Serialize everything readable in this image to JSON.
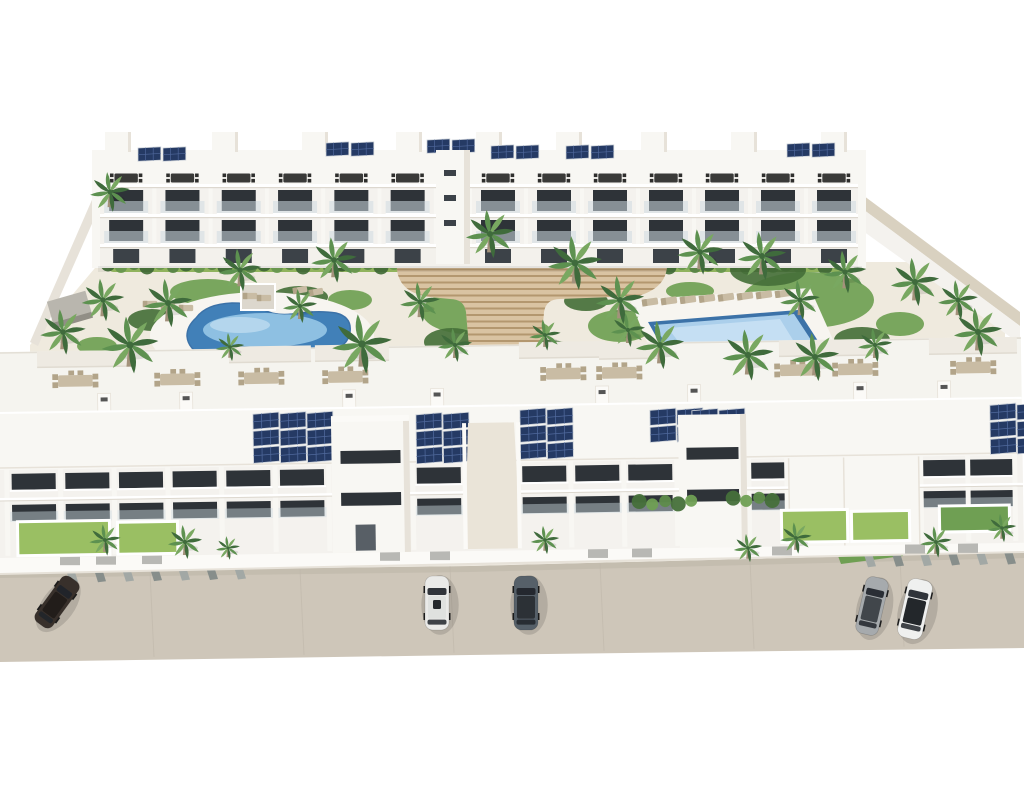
{
  "meta": {
    "description": "Aerial 3D architectural rendering of a white Mediterranean apartment complex: two long three-storey residential rows with rooftop terraces and solar panels, a landscaped central courtyard with palm trees, a kidney-shaped pool, a rectangular lap pool, wide wooden terraced steps, front gardens, and a street with parked cars."
  },
  "palette": {
    "bg": "#ffffff",
    "building_white": "#f8f7f3",
    "building_mid": "#f5f4ef",
    "building_shade": "#e7e2d9",
    "facade": "#f4f2ee",
    "window_dark": "#2e3338",
    "window_dark2": "#3c4248",
    "glass": "#cfdbe2",
    "slab_shadow": "#ddd8cf",
    "grass_green": "#9abf63",
    "garden_green": "#6f9f53",
    "hedge_green": "#5e8c4a",
    "hedge_dark": "#46703a",
    "palm_dark": "#3f6b3c",
    "palm_mid": "#5d9150",
    "palm_light": "#79a861",
    "trunk": "#a3927b",
    "ground": "#efeade",
    "deck_white": "#f7f5f0",
    "stairs_tan": "#d9c3a2",
    "stairs_dark": "#b3976f",
    "pool_deep": "#4180b8",
    "pool_light": "#9ccbe9",
    "pool_right": "#abcfeb",
    "pool_right_light": "#c9e2f4",
    "pool_rim": "#3c72a8",
    "street": "#cec6b9",
    "street_seam": "#c0b8ab",
    "street_dark": "#b9b1a4",
    "curb": "#ece7dd",
    "stripe_gray": "#a2a8a5",
    "stripe_dark": "#878e8b",
    "wall_tan": "#d9d1c0",
    "wall_white": "#fbfaf7",
    "solar_navy": "#253a64",
    "solar_line": "#50699c",
    "solar_frame": "#cfd4da",
    "furn_dark": "#3a3a38",
    "furn_tan": "#c9bca4",
    "furn_tan_dark": "#b2a489",
    "gray_panel": "#b8b8b4",
    "pavilion": "#b9b6ae",
    "car_dark": "#38302b",
    "car_white": "#eaeae8",
    "car_gray": "#566069",
    "car_silver": "#a6aaad",
    "car_white2": "#eff0ef"
  },
  "scene": {
    "street": {
      "stripe_xs_left": [
        64,
        92,
        120,
        148,
        176,
        204,
        232
      ],
      "stripe_xs_right": [
        862,
        890,
        918,
        946,
        974,
        1002
      ],
      "seam_xs": [
        150,
        300,
        450,
        600,
        750,
        900
      ]
    },
    "cars": [
      {
        "body": "car_dark",
        "roof": "#221d1a",
        "x": 57,
        "y": 602,
        "rot": 36,
        "l": 56,
        "w": 21,
        "sun": false
      },
      {
        "body": "car_white",
        "roof": "#dfe1df",
        "x": 437,
        "y": 603,
        "rot": 0,
        "l": 54,
        "w": 24,
        "sun": true
      },
      {
        "body": "car_gray",
        "roof": "#2c3136",
        "x": 526,
        "y": 603,
        "rot": 0,
        "l": 54,
        "w": 24,
        "sun": false
      },
      {
        "body": "car_silver",
        "roof": "#41464b",
        "x": 872,
        "y": 606,
        "rot": 13,
        "l": 58,
        "w": 23,
        "sun": false
      },
      {
        "body": "car_white2",
        "roof": "#23272b",
        "x": 915,
        "y": 609,
        "rot": 13,
        "l": 60,
        "w": 25,
        "sun": false
      }
    ],
    "palms": [
      [
        110,
        192,
        0.7
      ],
      [
        63,
        332,
        0.8
      ],
      [
        103,
        300,
        0.75
      ],
      [
        130,
        345,
        1.0
      ],
      [
        168,
        303,
        0.85
      ],
      [
        240,
        270,
        0.75
      ],
      [
        300,
        306,
        0.6
      ],
      [
        334,
        260,
        0.8
      ],
      [
        362,
        344,
        1.05
      ],
      [
        420,
        302,
        0.7
      ],
      [
        490,
        234,
        0.85
      ],
      [
        575,
        263,
        0.95
      ],
      [
        620,
        300,
        0.85
      ],
      [
        660,
        345,
        0.85
      ],
      [
        700,
        252,
        0.8
      ],
      [
        748,
        355,
        0.9
      ],
      [
        762,
        256,
        0.85
      ],
      [
        815,
        357,
        0.85
      ],
      [
        800,
        300,
        0.7
      ],
      [
        845,
        272,
        0.75
      ],
      [
        915,
        282,
        0.85
      ],
      [
        958,
        300,
        0.7
      ],
      [
        978,
        332,
        0.85
      ],
      [
        628,
        330,
        0.6
      ],
      [
        545,
        335,
        0.55
      ],
      [
        455,
        345,
        0.6
      ],
      [
        230,
        347,
        0.5
      ],
      [
        875,
        345,
        0.6
      ],
      [
        105,
        540,
        0.55
      ],
      [
        185,
        542,
        0.6
      ],
      [
        228,
        548,
        0.42
      ],
      [
        545,
        540,
        0.5
      ],
      [
        748,
        548,
        0.5
      ],
      [
        796,
        538,
        0.55
      ],
      [
        936,
        542,
        0.55
      ],
      [
        1002,
        528,
        0.5
      ]
    ],
    "bushes": [
      [
        468,
        312,
        46,
        22,
        1
      ],
      [
        452,
        342,
        28,
        14,
        0
      ],
      [
        620,
        326,
        32,
        16,
        1
      ],
      [
        808,
        300,
        66,
        28,
        1
      ],
      [
        768,
        270,
        38,
        16,
        0
      ],
      [
        862,
        340,
        28,
        13,
        0
      ],
      [
        900,
        324,
        24,
        12,
        1
      ],
      [
        208,
        292,
        38,
        13,
        1
      ],
      [
        300,
        297,
        28,
        11,
        0
      ],
      [
        152,
        320,
        24,
        11,
        0
      ],
      [
        97,
        346,
        20,
        9,
        1
      ],
      [
        548,
        352,
        28,
        12,
        0
      ],
      [
        586,
        301,
        22,
        10,
        0
      ],
      [
        690,
        291,
        24,
        9,
        1
      ],
      [
        432,
        371,
        22,
        11,
        0
      ],
      [
        944,
        356,
        22,
        11,
        1
      ],
      [
        350,
        300,
        22,
        10,
        1
      ],
      [
        530,
        330,
        20,
        9,
        1
      ]
    ],
    "hedges": [
      {
        "x0": 108,
        "x1": 432,
        "y": 265,
        "t": "top"
      },
      {
        "x0": 474,
        "x1": 858,
        "y": 265,
        "t": "top"
      },
      {
        "x0": 640,
        "x1": 702,
        "y": 512,
        "t": "bot"
      },
      {
        "x0": 734,
        "x1": 780,
        "y": 510,
        "t": "bot"
      }
    ],
    "top_row": {
      "blocks": [
        {
          "x0": 98,
          "modules": 6,
          "w": 56.3
        },
        {
          "x0": 470,
          "modules": 7,
          "w": 56
        }
      ],
      "solar": [
        [
          138,
          148
        ],
        [
          326,
          143
        ],
        [
          427,
          140
        ],
        [
          491,
          146
        ],
        [
          566,
          146
        ],
        [
          787,
          144
        ]
      ],
      "roof_boxes": [
        105,
        212,
        302,
        396,
        476,
        556,
        641,
        731,
        821
      ],
      "furniture_y": 178
    },
    "bottom_row": {
      "window_segments": [
        [
          8,
          330
        ],
        [
          414,
          466
        ],
        [
          519,
          678
        ],
        [
          750,
          788
        ],
        [
          922,
          1016
        ]
      ],
      "solar": [
        {
          "x": 255,
          "y": 418,
          "cols": 3,
          "rows": 3
        },
        {
          "x": 418,
          "y": 421,
          "cols": 2,
          "rows": 3
        },
        {
          "x": 522,
          "y": 418,
          "cols": 2,
          "rows": 3
        },
        {
          "x": 652,
          "y": 420,
          "cols": 2,
          "rows": 2
        },
        {
          "x": 694,
          "y": 421,
          "cols": 2,
          "rows": 3
        },
        {
          "x": 992,
          "y": 420,
          "cols": 2,
          "rows": 3
        }
      ],
      "furniture_xs": [
        78,
        180,
        264,
        348,
        566,
        622,
        800,
        858,
        976
      ],
      "furniture_y": 382,
      "pergolas": [
        [
          40,
          352,
          92
        ],
        [
          232,
          350,
          82
        ],
        [
          318,
          350,
          74
        ],
        [
          522,
          350,
          86
        ],
        [
          602,
          352,
          58
        ],
        [
          782,
          352,
          96
        ],
        [
          932,
          352,
          88
        ]
      ],
      "gate_xs": [
        60,
        96,
        142,
        380,
        430,
        588,
        632,
        772,
        905,
        958
      ],
      "chimney_xs": [
        100,
        182,
        345,
        433,
        598,
        690,
        856,
        940
      ]
    },
    "loungers": {
      "right_pool": {
        "x0": 650,
        "y": 302,
        "n": 8,
        "dx": 19,
        "rot": -8
      },
      "extra": [
        [
          250,
          296,
          0
        ],
        [
          264,
          298,
          0
        ],
        [
          300,
          290,
          -10
        ],
        [
          316,
          292,
          -10
        ],
        [
          150,
          304,
          0
        ],
        [
          168,
          306,
          0
        ],
        [
          186,
          308,
          0
        ]
      ]
    },
    "steps": {
      "stripe_top": 250,
      "stripe_bottom": 424,
      "step": 6.5
    }
  }
}
